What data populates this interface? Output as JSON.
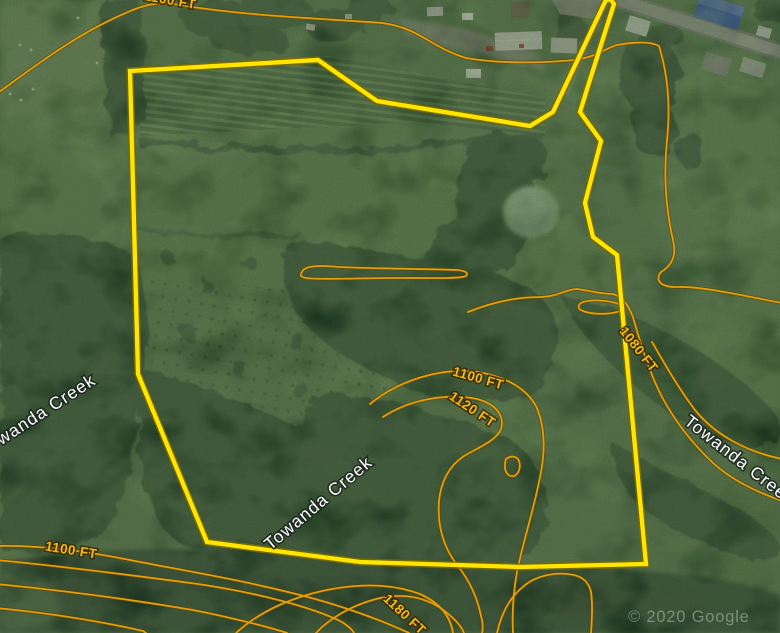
{
  "map": {
    "description": "Satellite aerial map with yellow parcel boundary and elevation contour overlay",
    "watermark": "© 2020 Google",
    "creek_labels": [
      {
        "text": "Towanda Creek",
        "cx": 38,
        "cy": 416,
        "rot": -33
      },
      {
        "text": "Towanda Creek",
        "cx": 319,
        "cy": 504,
        "rot": -40
      },
      {
        "text": "Towanda Creek",
        "cx": 739,
        "cy": 461,
        "rot": 38
      }
    ],
    "contour_labels": [
      {
        "text": "1100 FT",
        "cx": 71,
        "cy": 551,
        "rot": 9
      },
      {
        "text": "1100 FT",
        "cx": 478,
        "cy": 379,
        "rot": 16
      },
      {
        "text": "1120 FT",
        "cx": 472,
        "cy": 410,
        "rot": 34
      },
      {
        "text": "1080 FT",
        "cx": 638,
        "cy": 350,
        "rot": 52
      },
      {
        "text": "1180 FT",
        "cx": 404,
        "cy": 615,
        "rot": 43
      },
      {
        "text": "1100 FT",
        "cx": 170,
        "cy": 1,
        "rot": 10
      }
    ],
    "colors": {
      "parcel_boundary": "#ffe600",
      "contour_line": "#e3a008",
      "contour_label": "#f0bb14",
      "creek_label": "#ffffff"
    }
  }
}
